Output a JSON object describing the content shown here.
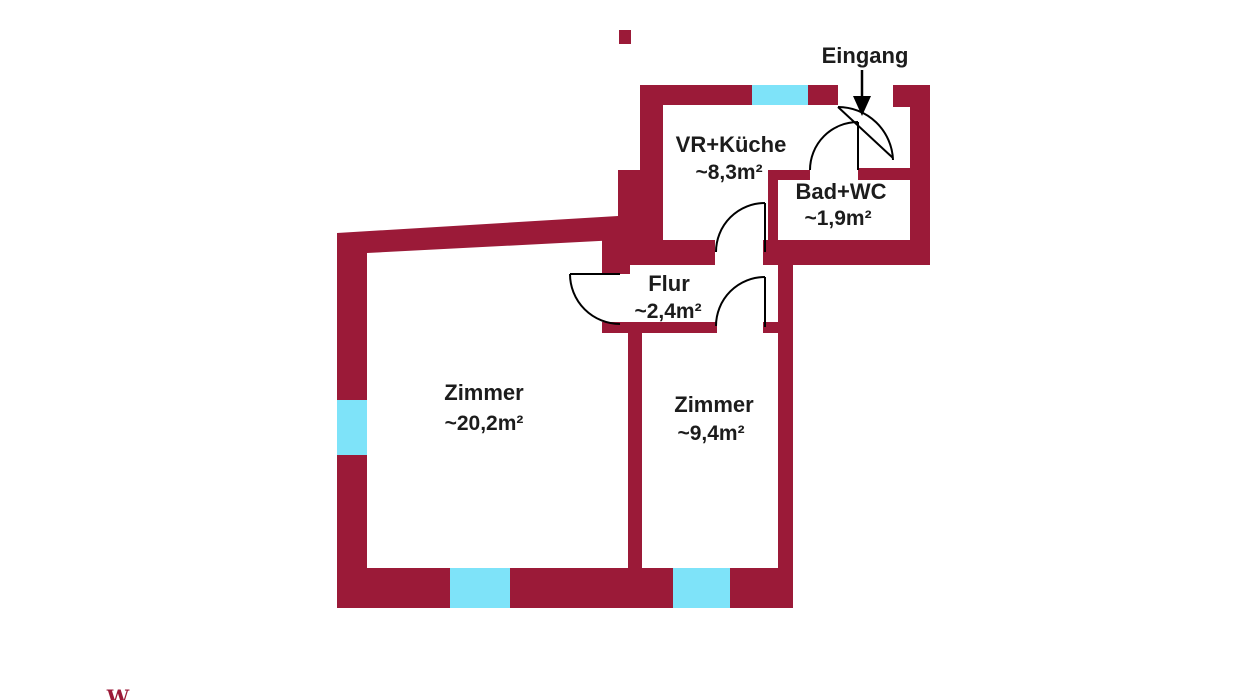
{
  "floorplan": {
    "entrance_label": "Eingang",
    "rooms": [
      {
        "name": "VR+Küche",
        "area": "~8,3m²"
      },
      {
        "name": "Bad+WC",
        "area": "~1,9m²"
      },
      {
        "name": "Flur",
        "area": "~2,4m²"
      },
      {
        "name": "Zimmer",
        "area": "~20,2m²"
      },
      {
        "name": "Zimmer",
        "area": "~9,4m²"
      }
    ],
    "watermark": "W",
    "colors": {
      "wall": "#9B1A38",
      "window": "#7EE3F9",
      "text": "#1C1C1C",
      "door_line": "#000000"
    }
  }
}
